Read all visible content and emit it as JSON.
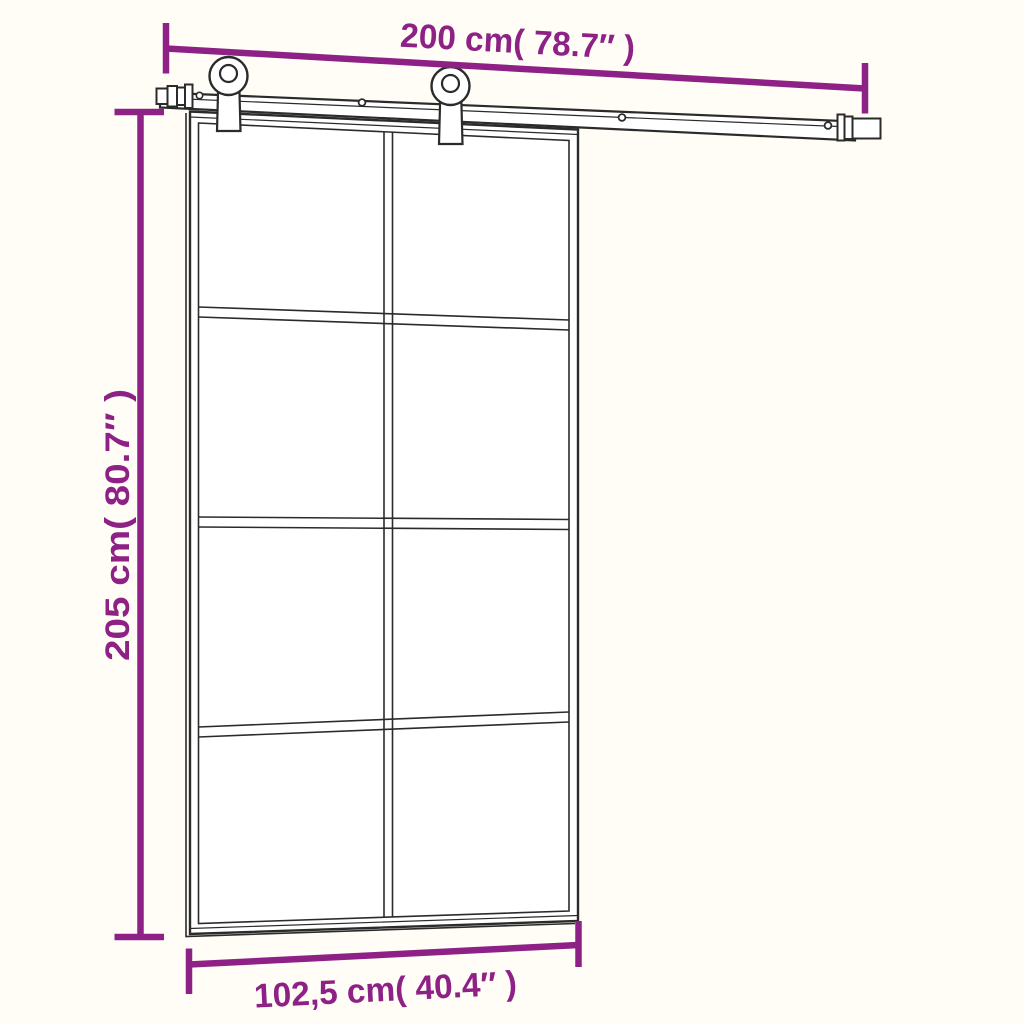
{
  "figure": {
    "kind": "sliding-door-dimension-diagram",
    "accent_color": "#8e2186",
    "line_color": "#2b2b2b",
    "background_color": "#fffdf6",
    "door": {
      "glass_columns": 2,
      "glass_rows": 4
    },
    "hardware": {
      "rollers": 2,
      "end_stops": 2,
      "visible_track_screws": 3
    }
  },
  "dimensions": {
    "track_width": {
      "label": "200 cm( 78.7″ )"
    },
    "door_height": {
      "label": "205 cm( 80.7″ )"
    },
    "door_width": {
      "label": "102,5 cm( 40.4″ )"
    }
  }
}
